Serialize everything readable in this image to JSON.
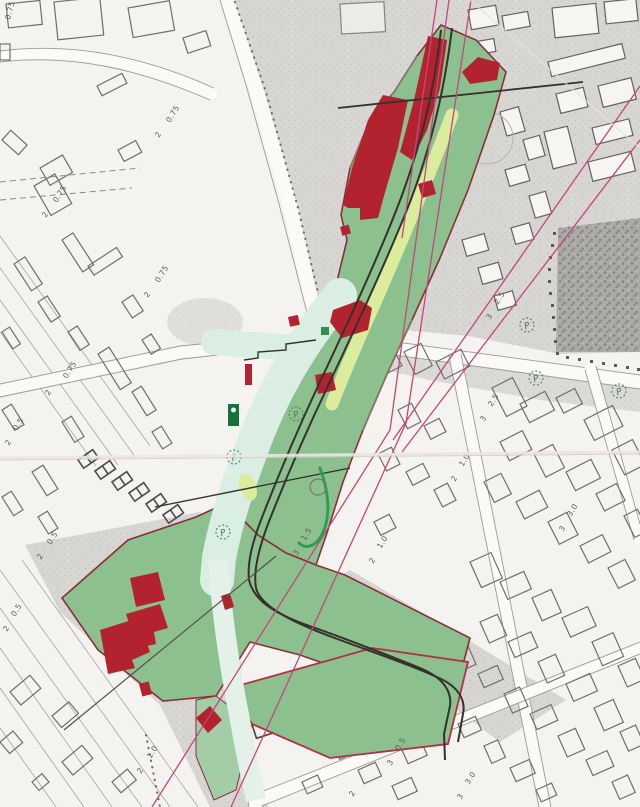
{
  "map": {
    "description": "Scanned cadastral zoning plan with hand-coloured green study corridor, red demolition patches and pink projection lines",
    "colors": {
      "paper": "#f5f3ef",
      "block_shading": "#d7d6d2",
      "cemetery_texture": "#9a9996",
      "plan_green": "#8cc18f",
      "plan_mint": "#d9ece3",
      "plan_lime": "#dcec9d",
      "demolition_red": "#b2232f",
      "boundary_maroon": "#8a2f3a",
      "projection_pink": "#c4467c",
      "alignment_black": "#35312c",
      "building_outline": "#6e6d6a",
      "label_gray": "#5a5a57",
      "accent_green": "#2f9e4f"
    },
    "height_labels": [
      {
        "text": "0.75",
        "x": 10,
        "y": 20,
        "rot": -75
      },
      {
        "text": "0.75",
        "x": 170,
        "y": 123,
        "rot": -58
      },
      {
        "text": "2",
        "x": 159,
        "y": 138,
        "rot": -58
      },
      {
        "text": "0.75",
        "x": 57,
        "y": 203,
        "rot": -58
      },
      {
        "text": "2",
        "x": 46,
        "y": 218,
        "rot": -58
      },
      {
        "text": "0.75",
        "x": 159,
        "y": 283,
        "rot": -58
      },
      {
        "text": "2",
        "x": 148,
        "y": 298,
        "rot": -58
      },
      {
        "text": "0.75",
        "x": 67,
        "y": 379,
        "rot": -58
      },
      {
        "text": "2",
        "x": 49,
        "y": 396,
        "rot": -58
      },
      {
        "text": "0.5",
        "x": 17,
        "y": 431,
        "rot": -58
      },
      {
        "text": "2",
        "x": 9,
        "y": 446,
        "rot": -58
      },
      {
        "text": "0.5",
        "x": 51,
        "y": 545,
        "rot": -58
      },
      {
        "text": "2",
        "x": 41,
        "y": 560,
        "rot": -58
      },
      {
        "text": "0.5",
        "x": 15,
        "y": 617,
        "rot": -58
      },
      {
        "text": "2",
        "x": 7,
        "y": 632,
        "rot": -58
      },
      {
        "text": "1.5",
        "x": 305,
        "y": 541,
        "rot": -58
      },
      {
        "text": "3",
        "x": 297,
        "y": 556,
        "rot": -58
      },
      {
        "text": "2.5",
        "x": 498,
        "y": 305,
        "rot": -58
      },
      {
        "text": "3",
        "x": 490,
        "y": 320,
        "rot": -58
      },
      {
        "text": "2.5",
        "x": 492,
        "y": 407,
        "rot": -58
      },
      {
        "text": "3",
        "x": 484,
        "y": 422,
        "rot": -58
      },
      {
        "text": "1.0",
        "x": 463,
        "y": 467,
        "rot": -58
      },
      {
        "text": "2",
        "x": 455,
        "y": 482,
        "rot": -58
      },
      {
        "text": "3.0",
        "x": 571,
        "y": 517,
        "rot": -58
      },
      {
        "text": "3",
        "x": 563,
        "y": 532,
        "rot": -58
      },
      {
        "text": "1.0",
        "x": 381,
        "y": 549,
        "rot": -58
      },
      {
        "text": "2",
        "x": 373,
        "y": 564,
        "rot": -58
      },
      {
        "text": "1.0",
        "x": 151,
        "y": 759,
        "rot": -58
      },
      {
        "text": "2",
        "x": 141,
        "y": 774,
        "rot": -58
      },
      {
        "text": "0.5",
        "x": 399,
        "y": 751,
        "rot": -58
      },
      {
        "text": "3",
        "x": 391,
        "y": 766,
        "rot": -58
      },
      {
        "text": "3.0",
        "x": 469,
        "y": 785,
        "rot": -58
      },
      {
        "text": "3",
        "x": 461,
        "y": 800,
        "rot": -58
      },
      {
        "text": "2",
        "x": 353,
        "y": 797,
        "rot": -58
      }
    ],
    "symbols": [
      {
        "glyph": "P",
        "x": 296,
        "y": 414,
        "style": "dashed"
      },
      {
        "glyph": "P",
        "x": 234,
        "y": 457,
        "style": "dashed"
      },
      {
        "glyph": "P",
        "x": 223,
        "y": 532,
        "style": "dashed"
      },
      {
        "glyph": "P",
        "x": 527,
        "y": 325,
        "style": "dashed"
      },
      {
        "glyph": "P",
        "x": 536,
        "y": 378,
        "style": "dashed"
      },
      {
        "glyph": "P",
        "x": 619,
        "y": 391,
        "style": "dashed"
      },
      {
        "glyph": "",
        "x": 318,
        "y": 487,
        "style": "plain"
      }
    ]
  }
}
